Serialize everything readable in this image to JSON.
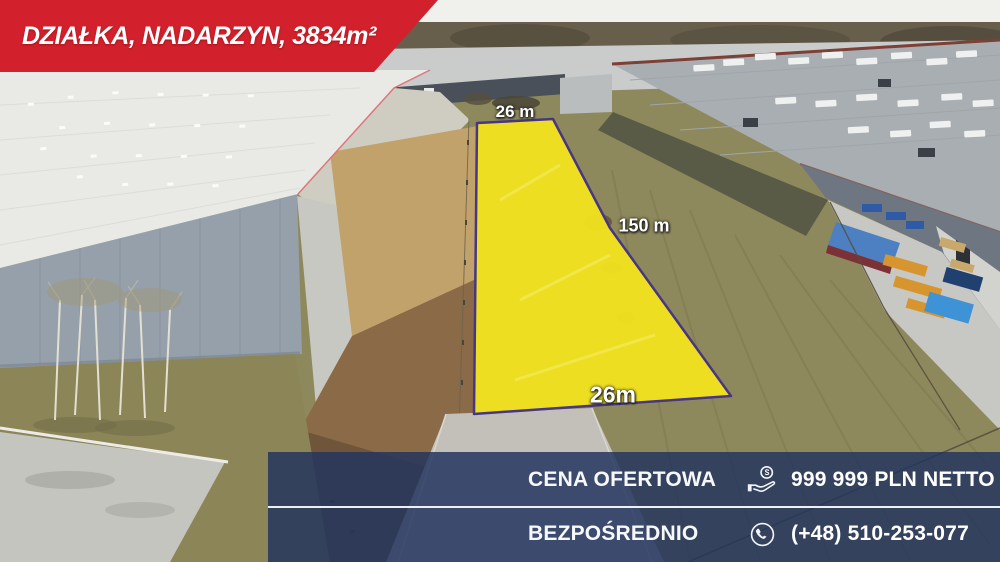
{
  "banner": {
    "title": "DZIAŁKA, NADARZYN, 3834m²",
    "bg_color": "#d2212c"
  },
  "plot": {
    "top_width_label": "26 m",
    "side_length_label": "150 m",
    "bottom_width_label": "26m",
    "fill_color": "#f2e31d",
    "border_color": "#473585"
  },
  "offer_panel": {
    "bg_color": "#22355e",
    "divider_color": "#f8fafc",
    "rows": [
      {
        "label": "CENA OFERTOWA",
        "icon": "price-hand-coin-icon",
        "value": "999 999 PLN NETTO"
      },
      {
        "label": "BEZPOŚREDNIO",
        "icon": "phone-icon",
        "value": "(+48) 510-253-077"
      }
    ]
  }
}
